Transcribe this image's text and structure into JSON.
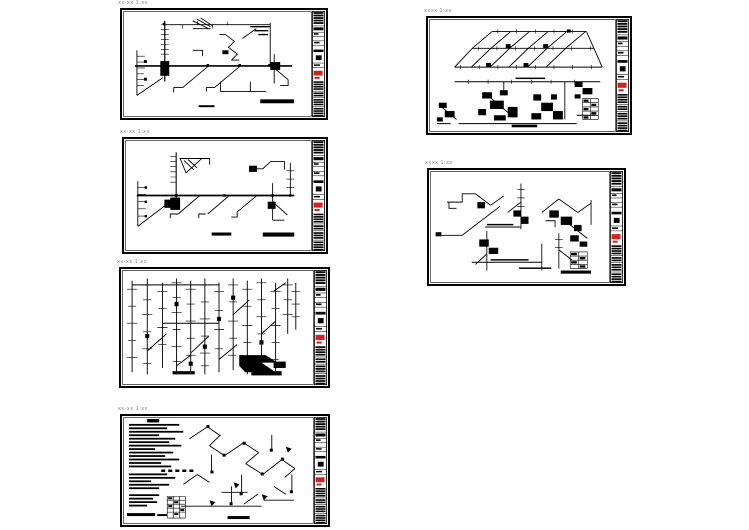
{
  "page": {
    "background": "#ffffff",
    "description": "six CAD drawing sheets arranged in two columns"
  },
  "colors": {
    "ink": "#000000",
    "stamp_red": "#d42020",
    "label_gray": "#8a8a8a",
    "paper": "#ffffff"
  },
  "sheets": [
    {
      "id": "sheet-1",
      "label": "xx-xx 1:xx",
      "type": "riser-network-diagram"
    },
    {
      "id": "sheet-2",
      "label": "xx-xx 1:xx",
      "type": "riser-network-diagram"
    },
    {
      "id": "sheet-3",
      "label": "xx-xx 1:xx",
      "type": "dense-riser-diagram"
    },
    {
      "id": "sheet-4",
      "label": "xx-xx 1:xx",
      "type": "notes-and-axonometric-diagram"
    },
    {
      "id": "sheet-5",
      "label": "xxxx 1:xx",
      "type": "axonometric-grid-diagram"
    },
    {
      "id": "sheet-6",
      "label": "xxxx 1:xx",
      "type": "axonometric-diagram"
    }
  ],
  "title_block": {
    "stamp_color": "#d42020",
    "position": "right-edge-strip"
  }
}
